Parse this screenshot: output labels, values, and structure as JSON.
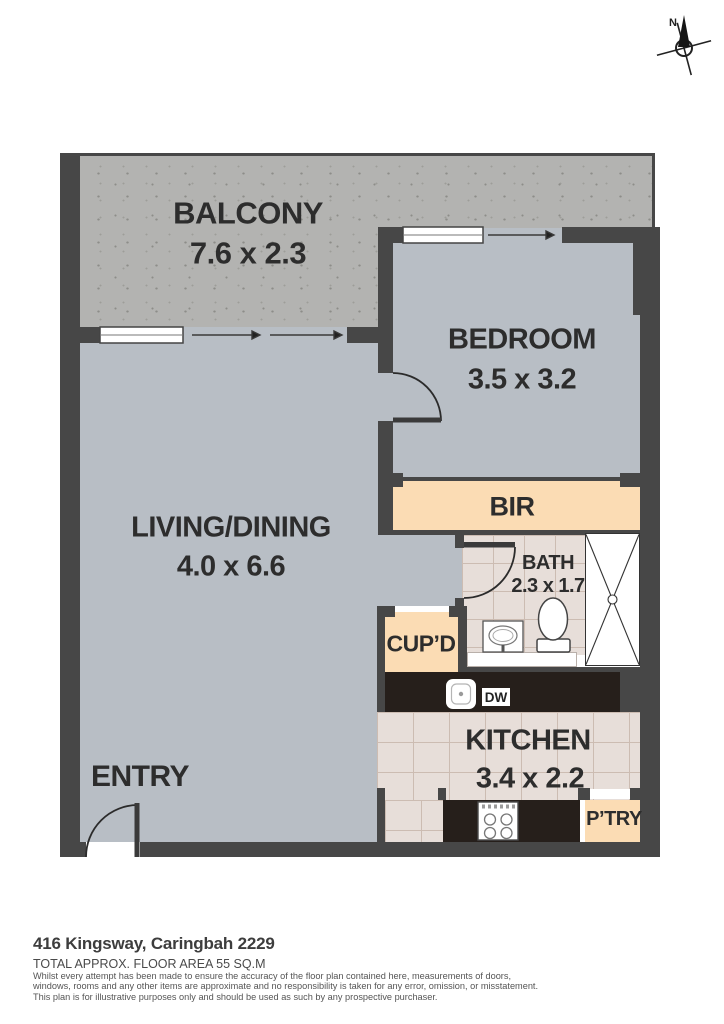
{
  "title": "Floor plan",
  "compass": {
    "north": "N"
  },
  "rooms": {
    "balcony": {
      "name": "BALCONY",
      "dims": "7.6 x 2.3"
    },
    "bedroom": {
      "name": "BEDROOM",
      "dims": "3.5 x 3.2"
    },
    "living": {
      "name": "LIVING/DINING",
      "dims": "4.0 x 6.6"
    },
    "bir": {
      "name": "BIR"
    },
    "bath": {
      "name": "BATH",
      "dims": "2.3 x 1.7"
    },
    "cupboard": {
      "name": "CUP’D"
    },
    "kitchen": {
      "name": "KITCHEN",
      "dims": "3.4 x 2.2"
    },
    "pantry": {
      "name": "P’TRY"
    },
    "dishwasher": {
      "name": "DW"
    },
    "entry": {
      "name": "ENTRY"
    }
  },
  "footer": {
    "address": "416 Kingsway, Caringbah 2229",
    "area": "TOTAL APPROX. FLOOR AREA 55 SQ.M",
    "disclaimer1": "Whilst every attempt has been made to ensure the accuracy of the floor plan contained here, measurements of doors,",
    "disclaimer2": "windows, rooms and any other items are approximate and no responsibility is taken for any error, omission, or misstatement.",
    "disclaimer3": "This plan is for illustrative purposes only and should be used as such by any prospective purchaser."
  },
  "colors": {
    "wall": "#474747",
    "floor": "#b8bec5",
    "balcony": "#b3b3b1",
    "speckle": "#8d8d89",
    "joinery": "#fbdcb4",
    "tile": "#e7ded9",
    "grout": "#ccbcb2",
    "counter": "#261f1b",
    "ink": "#2d2d2d",
    "line": "#333333"
  }
}
